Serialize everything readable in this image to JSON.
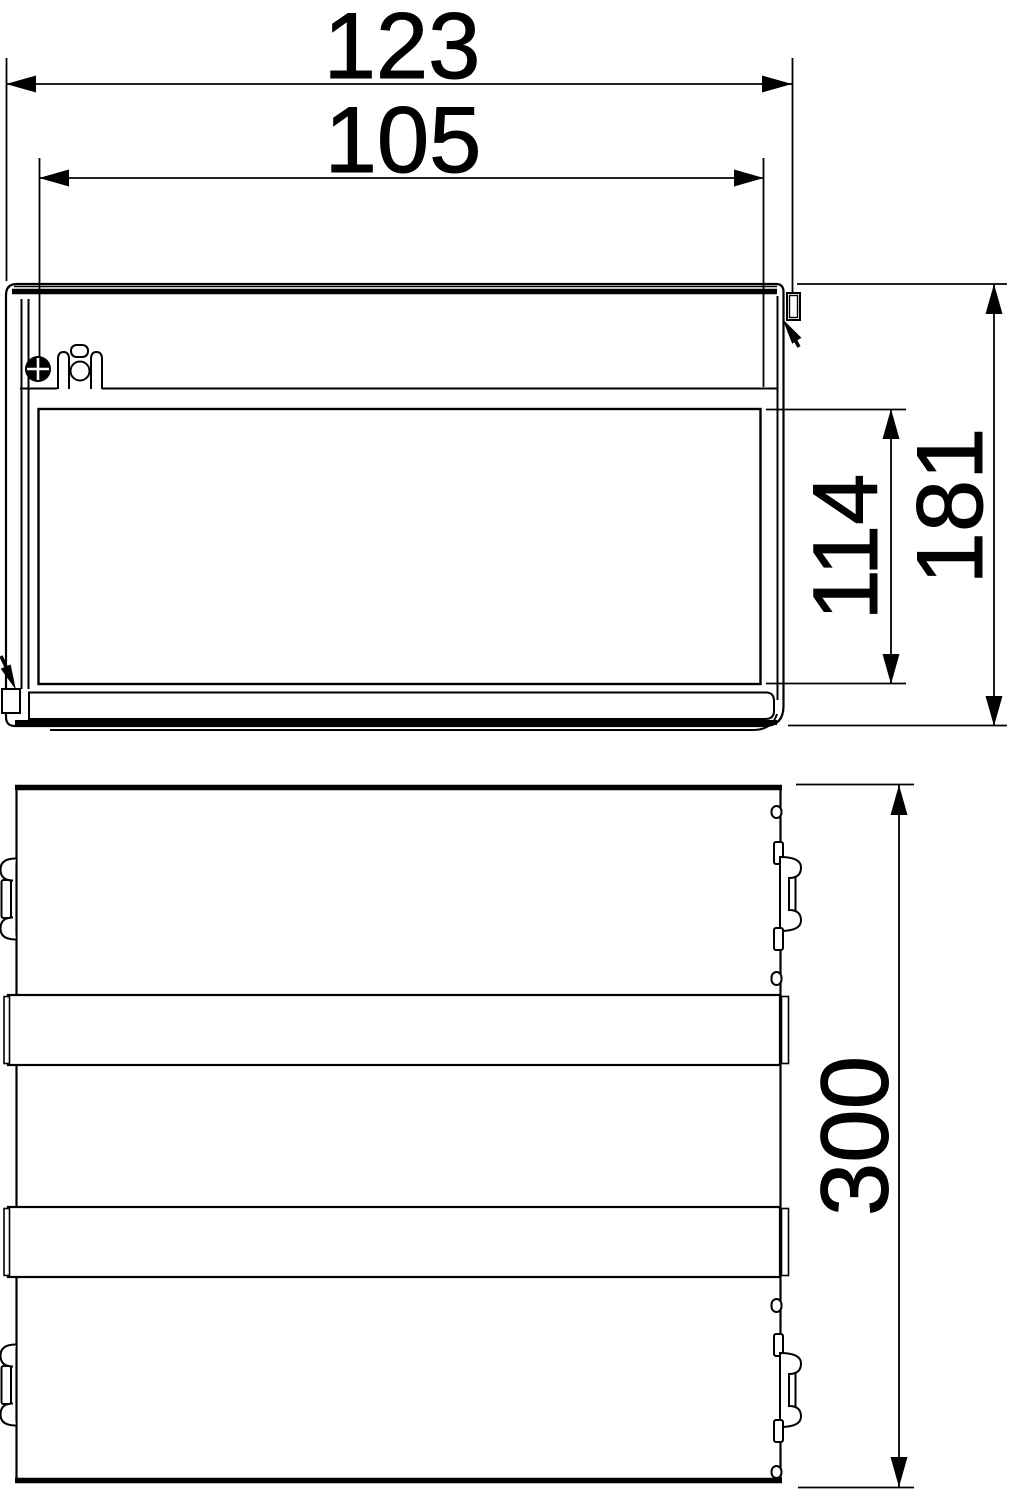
{
  "drawing": {
    "background": "#ffffff",
    "line_color": "#000000",
    "front_view": {
      "dim_overall_width": "123",
      "dim_lid_width": "105",
      "dim_inner_height": "114",
      "dim_overall_height": "181"
    },
    "top_view": {
      "dim_length": "300"
    }
  }
}
